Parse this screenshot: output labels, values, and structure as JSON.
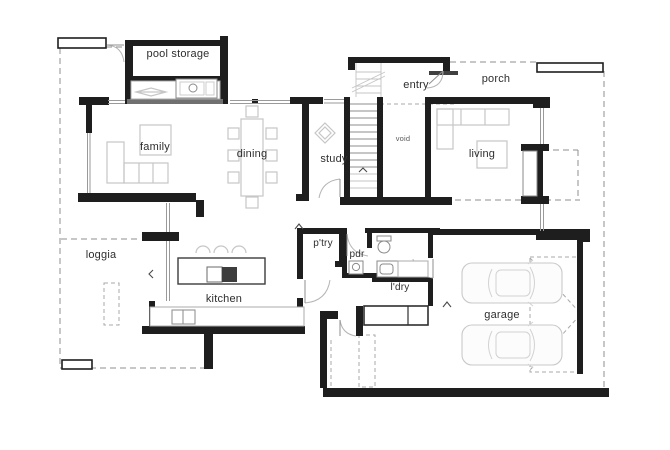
{
  "rooms": {
    "pool_storage": {
      "label": "pool storage"
    },
    "entry": {
      "label": "entry"
    },
    "porch": {
      "label": "porch"
    },
    "family": {
      "label": "family"
    },
    "dining": {
      "label": "dining"
    },
    "study": {
      "label": "study"
    },
    "void": {
      "label": "void"
    },
    "living": {
      "label": "living"
    },
    "loggia": {
      "label": "loggia"
    },
    "pantry": {
      "label": "p'try"
    },
    "powder_room": {
      "label": "pdr"
    },
    "laundry": {
      "label": "l'dry"
    },
    "kitchen": {
      "label": "kitchen"
    },
    "garage": {
      "label": "garage"
    }
  },
  "colors": {
    "wall": "#1e1e1e",
    "wall_gray": "#707070",
    "window_line": "#9a9a9a",
    "furniture": "#c6c6c6",
    "fixture": "#8a8a8a",
    "dashed": "#8f8f8f",
    "text": "#2e2e2e",
    "background": "#ffffff"
  }
}
